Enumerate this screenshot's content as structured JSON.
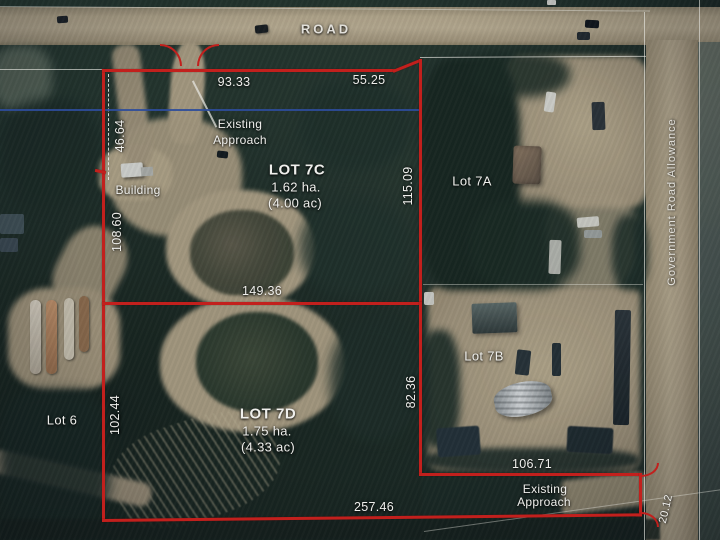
{
  "road": {
    "label": "ROAD"
  },
  "government_road_allowance": {
    "label": "Government Road Allowance"
  },
  "lots": {
    "lot_7c": {
      "name": "LOT 7C",
      "area_ha": "1.62 ha.",
      "area_ac": "(4.00 ac)"
    },
    "lot_7d": {
      "name": "LOT 7D",
      "area_ha": "1.75 ha.",
      "area_ac": "(4.33 ac)"
    },
    "lot_7a": {
      "name": "Lot 7A"
    },
    "lot_7b": {
      "name": "Lot 7B"
    },
    "lot_6": {
      "name": "Lot 6"
    }
  },
  "features": {
    "building": "Building",
    "approach_top_line1": "Existing",
    "approach_top_line2": "Approach",
    "approach_bottom_line1": "Existing",
    "approach_bottom_line2": "Approach"
  },
  "dimensions": {
    "lot7c_north_west": "93.33",
    "lot7c_north_east": "55.25",
    "west_upper": "46.64",
    "lot7c_west": "108.60",
    "lot7c_east": "115.09",
    "lot7c_south": "149.36",
    "lot7d_west": "102.44",
    "lot7d_east": "82.36",
    "approach_north": "106.71",
    "lot7d_south": "257.46",
    "road_allowance_width": "20.12"
  },
  "colors": {
    "boundary": "#c2201d",
    "survey_line": "#e8e8e2",
    "utility_line": "#2d4d9b",
    "label_text": "#efefec",
    "road_tan": "#b2a489",
    "vegetation": "#20302a"
  }
}
